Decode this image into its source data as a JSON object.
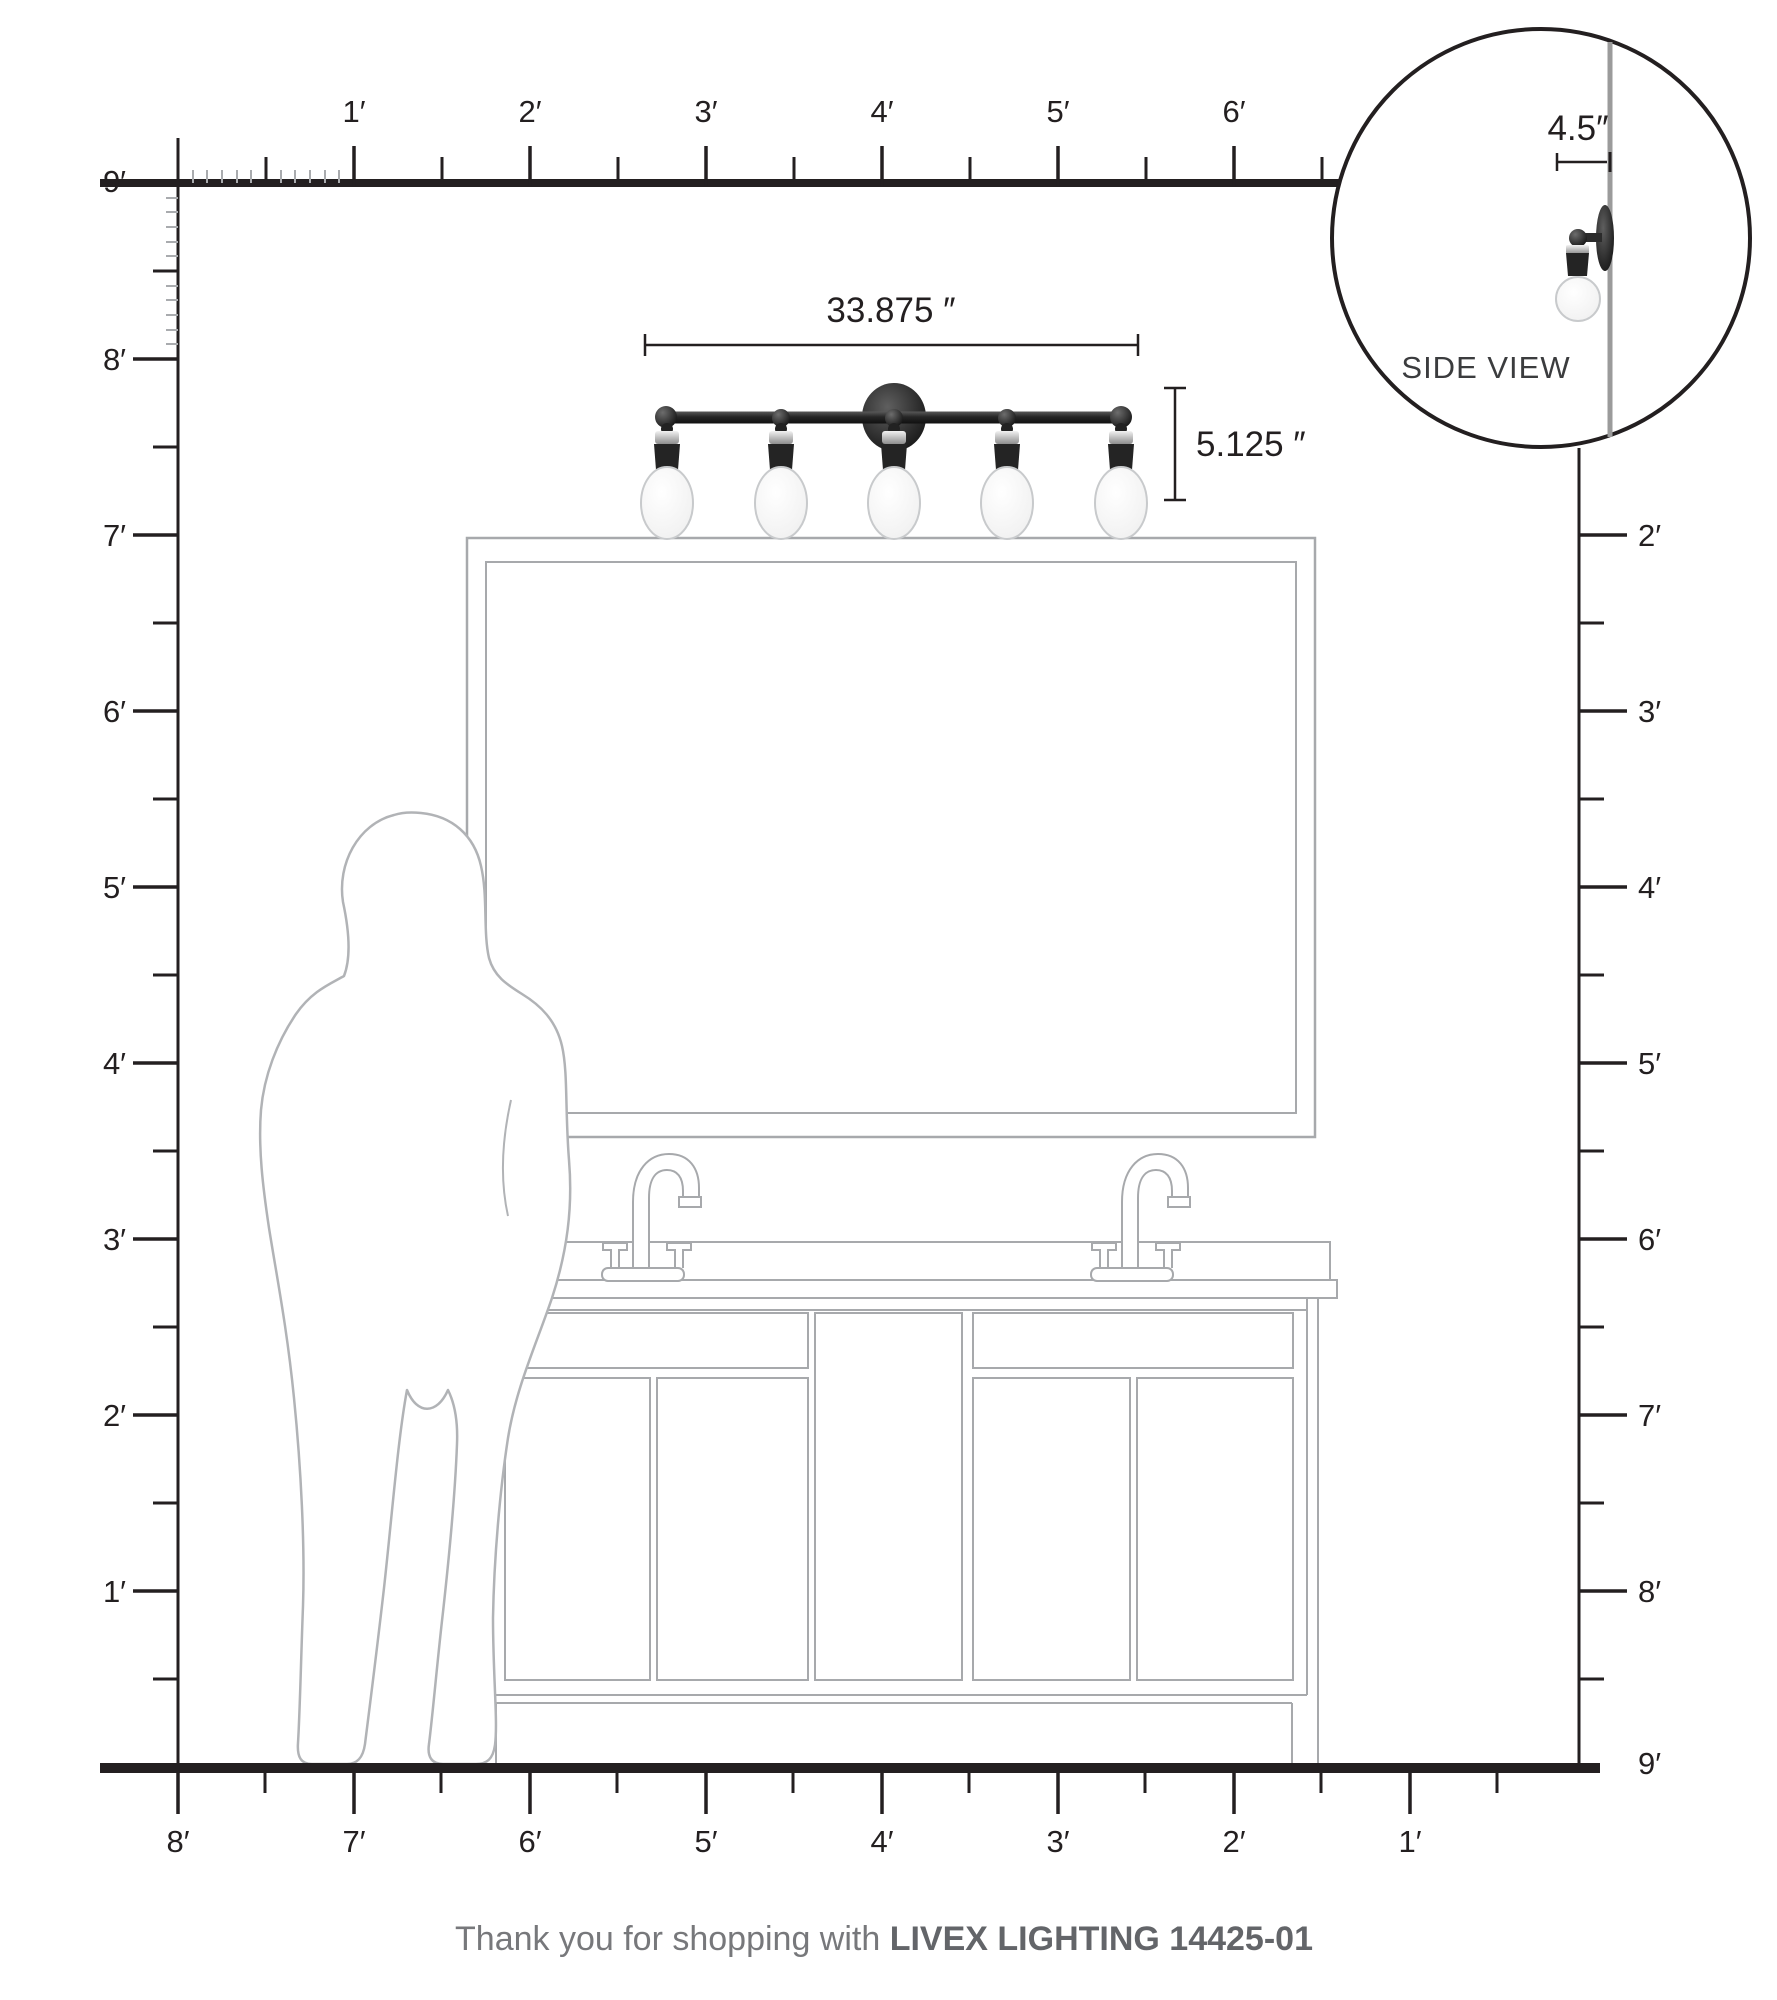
{
  "rulers": {
    "top": [
      "1′",
      "2′",
      "3′",
      "4′",
      "5′",
      "6′"
    ],
    "left": [
      "9′",
      "8′",
      "7′",
      "6′",
      "5′",
      "4′",
      "3′",
      "2′",
      "1′"
    ],
    "right": [
      "2′",
      "3′",
      "4′",
      "5′",
      "6′",
      "7′",
      "8′",
      "9′"
    ],
    "bottom": [
      "8′",
      "7′",
      "6′",
      "5′",
      "4′",
      "3′",
      "2′",
      "1′"
    ]
  },
  "dimensions": {
    "fixture_width": "33.875 ″",
    "fixture_height": "5.125 ″",
    "fixture_depth": "4.5″"
  },
  "side_view": {
    "label": "SIDE VIEW"
  },
  "footer": {
    "message": "Thank you for shopping with ",
    "brand": "LIVEX LIGHTING 14425-01"
  },
  "colors": {
    "ink": "#231f20",
    "drawing_gray": "#a7a9ac",
    "silhouette_gray": "#b1b3b6",
    "wall_gray": "#9b9b9b",
    "fixture_dark": "#2b2b2b",
    "chrome": "#d9d9d9",
    "footer_text": "#77787b",
    "footer_brand": "#636569"
  }
}
